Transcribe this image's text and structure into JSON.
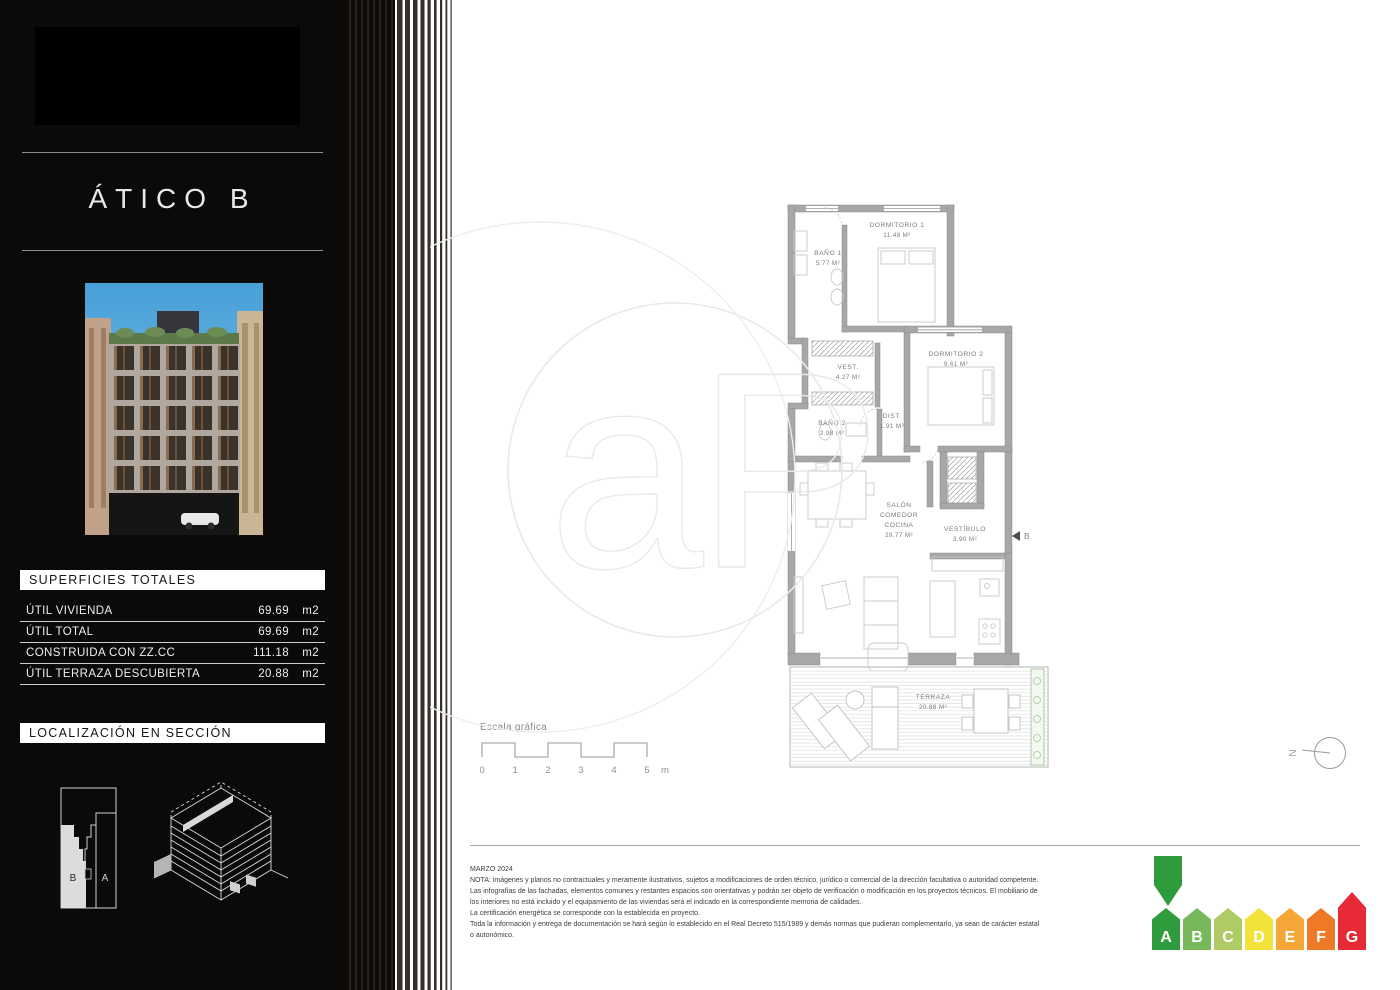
{
  "sidebar": {
    "title": "ÁTICO B",
    "surfaces": {
      "header": "SUPERFICIES TOTALES",
      "rows": [
        {
          "label": "ÚTIL VIVIENDA",
          "value": "69.69",
          "unit": "m2"
        },
        {
          "label": "ÚTIL TOTAL",
          "value": "69.69",
          "unit": "m2"
        },
        {
          "label": "CONSTRUIDA CON ZZ.CC",
          "value": "111.18",
          "unit": "m2"
        },
        {
          "label": "ÚTIL TERRAZA DESCUBIERTA",
          "value": "20.88",
          "unit": "m2"
        }
      ]
    },
    "location": {
      "header": "LOCALIZACIÓN EN SECCIÓN",
      "unit_b": "B",
      "unit_a": "A"
    }
  },
  "plan": {
    "rooms": {
      "dormitorio1": {
        "name": "DORMITORIO 1",
        "area": "11.48 M²"
      },
      "bano1": {
        "name": "BAÑO 1",
        "area": "5.77 M²"
      },
      "vest": {
        "name": "VEST.",
        "area": "4.27 M²"
      },
      "dormitorio2": {
        "name": "DORMITORIO 2",
        "area": "9.61 M²"
      },
      "dist": {
        "name": "DIST.",
        "area": "1.91 M²"
      },
      "bano2": {
        "name": "BAÑO 2",
        "area": "2.98 M²"
      },
      "salon": {
        "name_line1": "SALÓN",
        "name_line2": "COMEDOR",
        "name_line3": "COCINA",
        "area": "29.77 M²"
      },
      "vestibulo": {
        "name": "VESTÍBULO",
        "area": "3.90 M²"
      },
      "terraza": {
        "name": "TERRAZA",
        "area": "20.88 M²"
      }
    },
    "entrance_label": "B",
    "compass_label": "N"
  },
  "watermark": {
    "text": "aP"
  },
  "scalebar": {
    "title": "Escala gráfica",
    "ticks": [
      "0",
      "1",
      "2",
      "3",
      "4",
      "5"
    ],
    "unit": "m"
  },
  "footer": {
    "date": "MARZO 2024",
    "lines": [
      "NOTA: imágenes y planos no contractuales y meramente ilustrativos, sujetos a modificaciones de orden técnico, jurídico o comercial de la dirección facultativa o autoridad competente.",
      "Las infografías de las fachadas, elementos comunes y restantes espacios son orientativas y podrán ser objeto de verificación o modificación en los proyectos técnicos. El mobiliario de",
      "los interiores no está incluido y el equipamiento de las viviendas será el indicado en la correspondiente memoria de calidades.",
      "La certificación energética se corresponde con la establecida en proyecto.",
      "Toda la información y entrega de documentación se hará según lo establecido en el Real Decreto 515/1989 y demás normas que pudieran complementarlo, ya sean de carácter estatal",
      "o autonómico."
    ]
  },
  "energy": {
    "active": "A",
    "arrow_color": "#2E9B3D",
    "letters": [
      "A",
      "B",
      "C",
      "D",
      "E",
      "F",
      "G"
    ],
    "colors": [
      "#2E9B3D",
      "#77B95A",
      "#AECB66",
      "#F2E239",
      "#F4A636",
      "#EE7A27",
      "#E62B37"
    ]
  }
}
